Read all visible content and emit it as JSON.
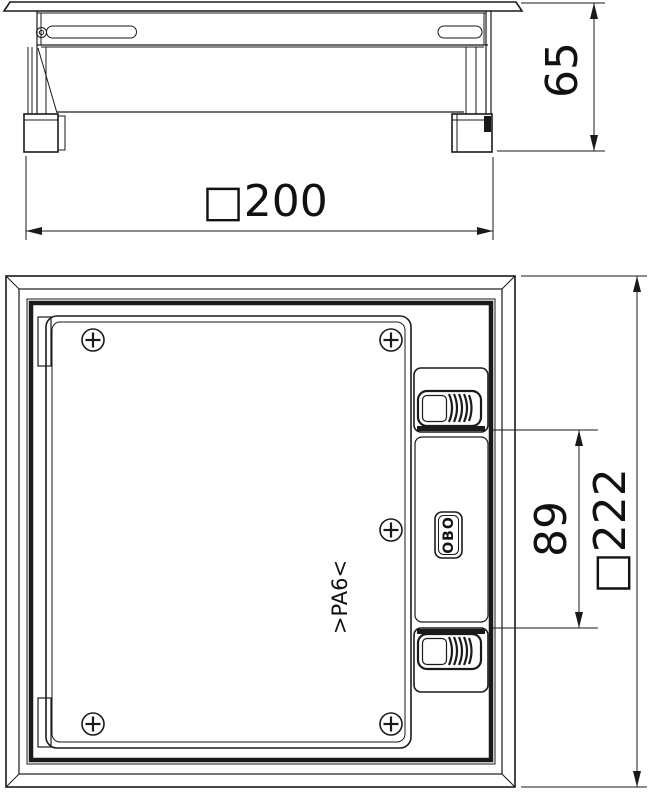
{
  "colors": {
    "line": "#1a1a1a",
    "background": "#ffffff"
  },
  "side_view": {
    "height_dim_label": "65",
    "width_dim_label": "□200"
  },
  "plan_view": {
    "overall_dim_label": "□222",
    "latch_section_dim_label": "89",
    "brand_logo": "OBO",
    "material_marking": ">PA6<"
  }
}
